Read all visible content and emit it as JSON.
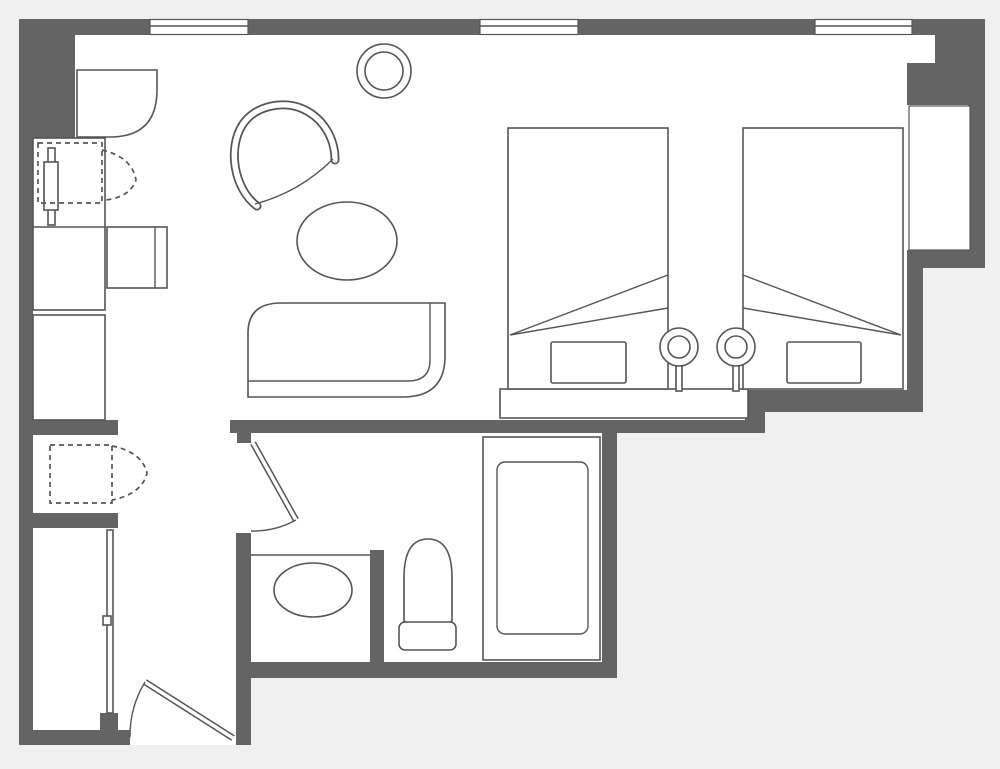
{
  "meta": {
    "title": "Hotel guest room floor plan",
    "diagram_type": "architectural-floor-plan",
    "visible_text": []
  },
  "colors": {
    "outside_bg": "#f0f0f0",
    "floor": "#ffffff",
    "wall": "#646464",
    "line": "#555555"
  },
  "plan": {
    "rooms": [
      {
        "id": "bedroom-living-area"
      },
      {
        "id": "entry-corridor"
      },
      {
        "id": "bathroom"
      },
      {
        "id": "closet-area"
      }
    ],
    "openings": {
      "top_wall_windows": 3,
      "bay_window": 1,
      "swing_doors": [
        "entry-door",
        "bathroom-door"
      ],
      "folding_doors": [
        "closet-bifold-door-upper",
        "closet-bifold-door-lower"
      ],
      "sliding_doors": [
        "wardrobe-sliding-door"
      ]
    },
    "furniture_symbols": [
      "twin-bed",
      "twin-bed",
      "pillow",
      "pillow",
      "table-lamp",
      "table-lamp",
      "headboard-bench",
      "sofa",
      "lounge-chair",
      "oval-coffee-table",
      "round-side-table",
      "desk-with-chair",
      "corner-cabinet",
      "mirror-board",
      "luggage-rack-dashed"
    ],
    "bathroom_fixtures": [
      "bathtub",
      "toilet",
      "sink-counter",
      "sink-basin"
    ]
  }
}
